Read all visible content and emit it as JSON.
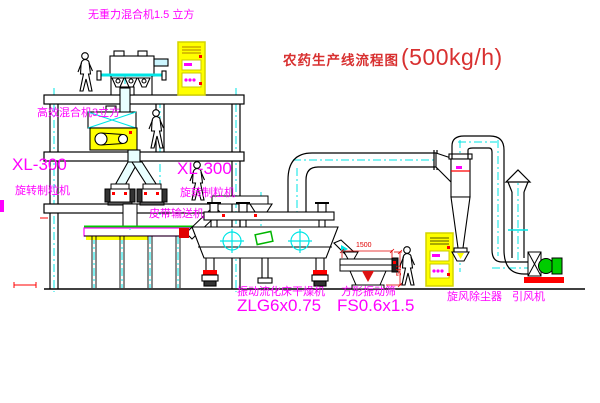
{
  "title": {
    "text": "农药生产线流程图",
    "capacity": "(500kg/h)"
  },
  "labels": {
    "gravity_free_mixer": "无重力混合机1.5 立方",
    "high_efficiency_mixer": "高效混合机3立方",
    "granulator_left_model": "XL-300",
    "granulator_left_name": "旋转制粒机",
    "granulator_right_model": "XL-300",
    "granulator_right_name": "旋转制粒机",
    "belt_conveyor": "皮带输送机",
    "dryer_name": "振动流化床干燥机",
    "dryer_model": "ZLG6x0.75",
    "sieve_name": "方形振动筛",
    "sieve_model": "FS0.6x1.5",
    "cyclone": "旋风除尘器",
    "fan": "引风机"
  },
  "dimensions": {
    "sieve_length": "1500",
    "sieve_height": "541"
  },
  "colors": {
    "line_black": "#000000",
    "centerline_cyan": "#00e5e5",
    "label_magenta": "#ff00ff",
    "title_red": "#d83030",
    "highlight_yellow": "#ffff00",
    "accent_red": "#ff0000",
    "belt_green": "#00c800"
  }
}
